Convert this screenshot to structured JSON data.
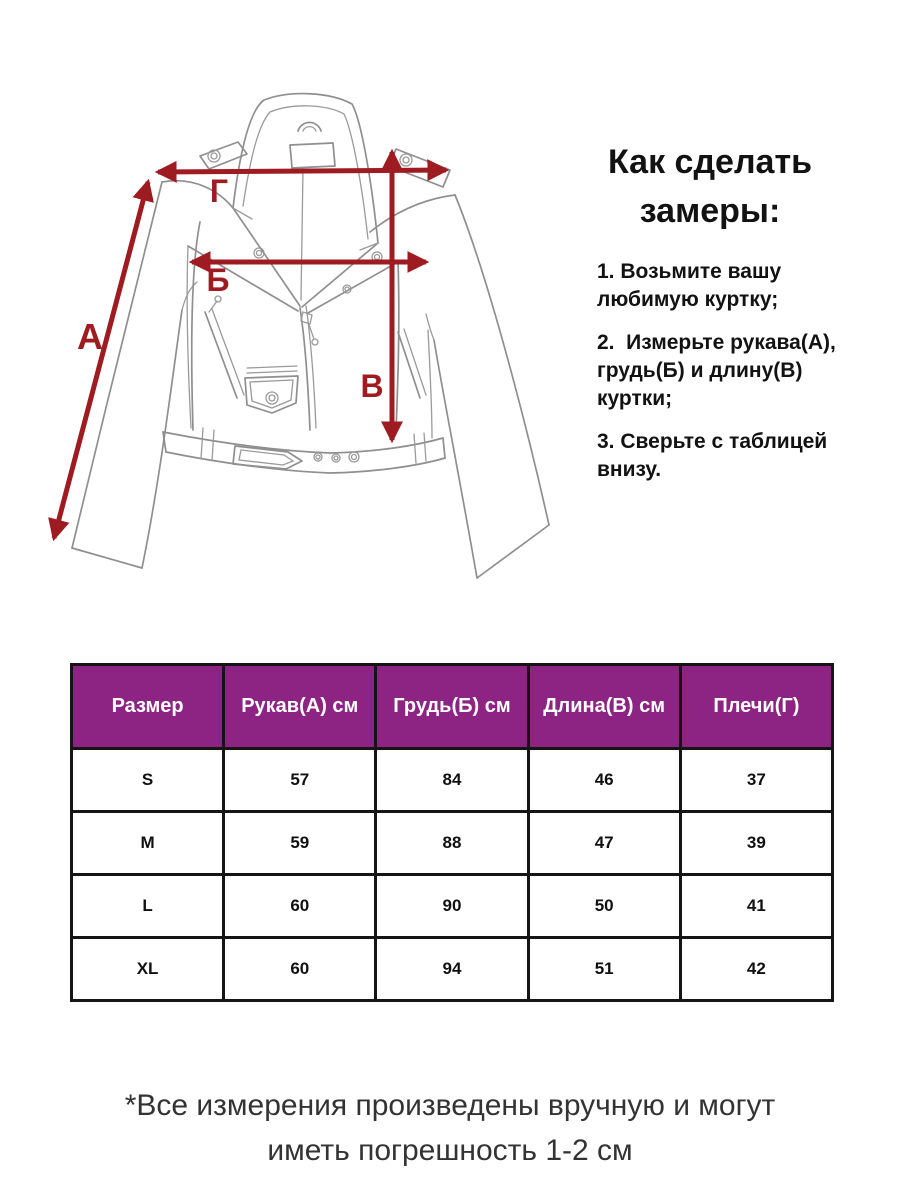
{
  "illustration": {
    "labels": {
      "sleeve": "А",
      "chest": "Б",
      "length": "В",
      "shoulders": "Г"
    },
    "arrow_color": "#9e1c21"
  },
  "howto": {
    "title": "Как сделать замеры:",
    "steps": [
      "1. Возьмите вашу любимую куртку;",
      "2.  Измерьте рукава(А), грудь(Б) и длину(В) куртки;",
      "3. Сверьте с таблицей внизу."
    ]
  },
  "size_table": {
    "header_bg": "#8d2484",
    "header_text_color": "#ffffff",
    "border_color": "#151515",
    "columns": [
      "Размер",
      "Рукав(А) см",
      "Грудь(Б) см",
      "Длина(В) см",
      "Плечи(Г)"
    ],
    "rows": [
      [
        "S",
        "57",
        "84",
        "46",
        "37"
      ],
      [
        "M",
        "59",
        "88",
        "47",
        "39"
      ],
      [
        "L",
        "60",
        "90",
        "50",
        "41"
      ],
      [
        "XL",
        "60",
        "94",
        "51",
        "42"
      ]
    ]
  },
  "footnote": "*Все измерения произведены вручную и могут иметь погрешность 1-2 см"
}
